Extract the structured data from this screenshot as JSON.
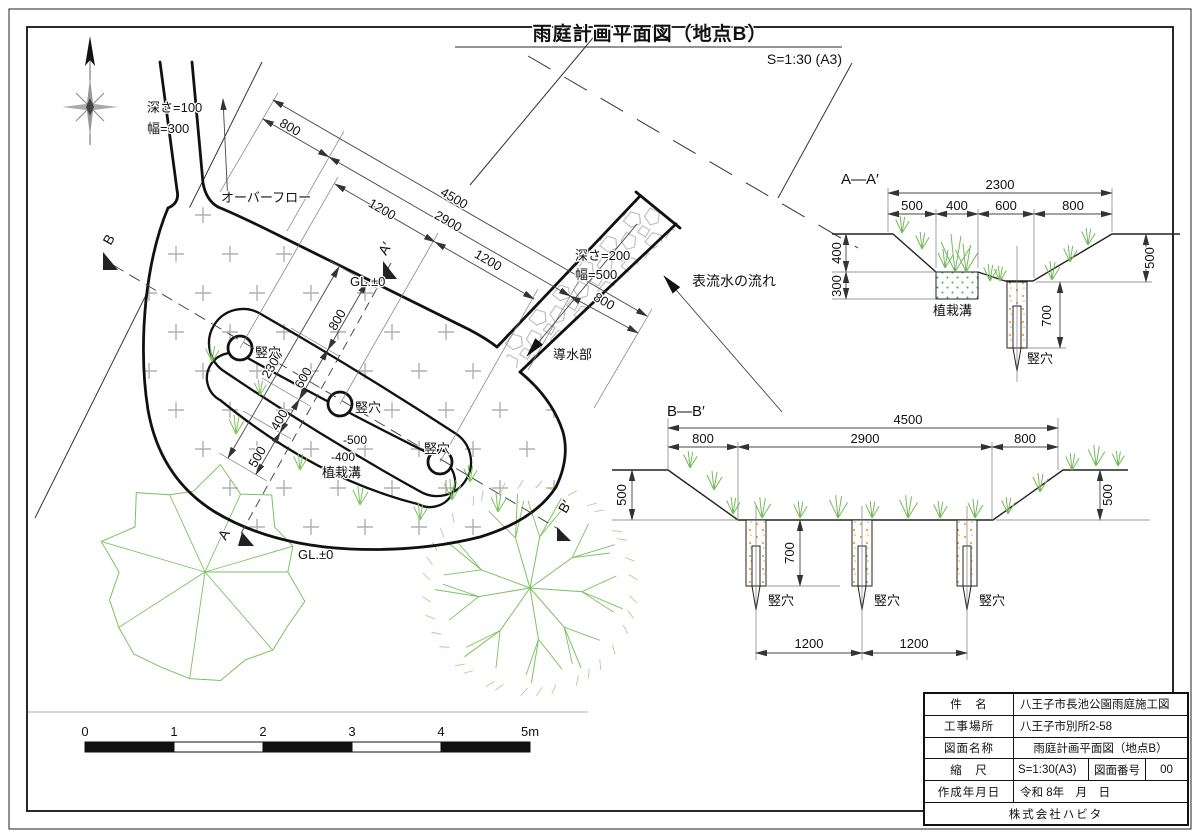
{
  "title": {
    "text": "雨庭計画平面図（地点B）",
    "scale": "S=1:30 (A3)"
  },
  "scale_bar": {
    "ticks": [
      "0",
      "1",
      "2",
      "3",
      "4",
      "5m"
    ]
  },
  "title_block": {
    "rows": [
      {
        "label": "件　名",
        "value": "八王子市長池公園雨庭施工図"
      },
      {
        "label": "工事場所",
        "value": "八王子市別所2-58"
      },
      {
        "label": "図面名称",
        "value": "雨庭計画平面図（地点B）"
      },
      {
        "label": "縮　尺",
        "value": "S=1:30(A3)",
        "label2": "図面番号",
        "value2": "00"
      },
      {
        "label": "作成年月日",
        "value": "令和 8年　月　日"
      }
    ],
    "company": "株式会社ハビタ"
  },
  "labels": [
    {
      "name": "drawing-title",
      "text": "雨庭計画平面図（地点B）",
      "x": 650,
      "y": 40,
      "size": 19,
      "anchor": "middle",
      "bold": true
    },
    {
      "name": "drawing-scale-note",
      "text": "S=1:30 (A3)",
      "x": 842,
      "y": 64,
      "size": 14,
      "anchor": "end"
    },
    {
      "name": "inflow-note-depth",
      "text": "深さ=100",
      "x": 147,
      "y": 112,
      "size": 13,
      "anchor": "start"
    },
    {
      "name": "inflow-note-width",
      "text": "幅=300",
      "x": 147,
      "y": 133,
      "size": 13,
      "anchor": "start"
    },
    {
      "name": "overflow-label",
      "text": "オーバーフロー",
      "x": 221,
      "y": 202,
      "size": 13,
      "anchor": "start"
    },
    {
      "name": "dim-800-top-left",
      "text": "800",
      "x": 288,
      "y": 131,
      "size": 13,
      "anchor": "middle",
      "rot": 30
    },
    {
      "name": "dim-4500",
      "text": "4500",
      "x": 452,
      "y": 202,
      "size": 13,
      "anchor": "middle",
      "rot": 30
    },
    {
      "name": "dim-1200-left",
      "text": "1200",
      "x": 380,
      "y": 213,
      "size": 13,
      "anchor": "middle",
      "rot": 30
    },
    {
      "name": "dim-2900",
      "text": "2900",
      "x": 446,
      "y": 225,
      "size": 13,
      "anchor": "middle",
      "rot": 30
    },
    {
      "name": "dim-1200-right",
      "text": "1200",
      "x": 486,
      "y": 264,
      "size": 13,
      "anchor": "middle",
      "rot": 30
    },
    {
      "name": "dim-800-conduit",
      "text": "800",
      "x": 602,
      "y": 305,
      "size": 13,
      "anchor": "middle",
      "rot": 30
    },
    {
      "name": "dim-2300-cross",
      "text": "2300",
      "x": 276,
      "y": 367,
      "size": 13,
      "anchor": "middle",
      "rot": -60
    },
    {
      "name": "dim-800-cross",
      "text": "800",
      "x": 341,
      "y": 322,
      "size": 13,
      "anchor": "middle",
      "rot": -60
    },
    {
      "name": "dim-600-cross",
      "text": "600",
      "x": 307,
      "y": 380,
      "size": 13,
      "anchor": "middle",
      "rot": -60
    },
    {
      "name": "dim-400-cross",
      "text": "400",
      "x": 283,
      "y": 422,
      "size": 13,
      "anchor": "middle",
      "rot": -60
    },
    {
      "name": "dim-500-cross",
      "text": "500",
      "x": 261,
      "y": 459,
      "size": 13,
      "anchor": "middle",
      "rot": -60
    },
    {
      "name": "gl-label-top",
      "text": "GL.±0",
      "x": 350,
      "y": 286,
      "size": 13,
      "anchor": "start"
    },
    {
      "name": "gl-label-bottom",
      "text": "GL.±0",
      "x": 298,
      "y": 559,
      "size": 13,
      "anchor": "start"
    },
    {
      "name": "section-mark-a-prime",
      "text": "A′",
      "x": 389,
      "y": 251,
      "size": 14,
      "anchor": "middle",
      "rot": -60
    },
    {
      "name": "section-mark-a",
      "text": "A",
      "x": 228,
      "y": 537,
      "size": 14,
      "anchor": "middle",
      "rot": -60
    },
    {
      "name": "section-mark-b",
      "text": "B",
      "x": 113,
      "y": 242,
      "size": 14,
      "anchor": "middle",
      "rot": -60
    },
    {
      "name": "section-mark-b-prime",
      "text": "B′",
      "x": 569,
      "y": 509,
      "size": 14,
      "anchor": "middle",
      "rot": -60
    },
    {
      "name": "pit-label-plan-1",
      "text": "竪穴",
      "x": 255,
      "y": 357,
      "size": 13,
      "anchor": "start"
    },
    {
      "name": "pit-label-plan-2",
      "text": "竪穴",
      "x": 355,
      "y": 412,
      "size": 13,
      "anchor": "start"
    },
    {
      "name": "pit-label-plan-3",
      "text": "竪穴",
      "x": 424,
      "y": 453,
      "size": 13,
      "anchor": "start"
    },
    {
      "name": "level-label-minus500",
      "text": "-500",
      "x": 343,
      "y": 444,
      "size": 12,
      "anchor": "start"
    },
    {
      "name": "level-label-minus400",
      "text": "-400",
      "x": 331,
      "y": 461,
      "size": 12,
      "anchor": "start"
    },
    {
      "name": "planting-label-plan",
      "text": "植栽溝",
      "x": 322,
      "y": 477,
      "size": 13,
      "anchor": "start"
    },
    {
      "name": "conduit-note-depth",
      "text": "深さ=200",
      "x": 575,
      "y": 260,
      "size": 13,
      "anchor": "start"
    },
    {
      "name": "conduit-note-width",
      "text": "幅=500",
      "x": 575,
      "y": 279,
      "size": 13,
      "anchor": "start"
    },
    {
      "name": "conduit-label",
      "text": "導水部",
      "x": 553,
      "y": 359,
      "size": 13,
      "anchor": "start"
    },
    {
      "name": "surface-flow-label",
      "text": "表流水の流れ",
      "x": 692,
      "y": 286,
      "size": 14,
      "anchor": "start"
    },
    {
      "name": "section-aa-title",
      "text": "A—A′",
      "x": 841,
      "y": 184,
      "size": 15,
      "anchor": "start"
    },
    {
      "name": "dim-aa-2300",
      "text": "2300",
      "x": 1000,
      "y": 189,
      "size": 13,
      "anchor": "middle"
    },
    {
      "name": "dim-aa-500",
      "text": "500",
      "x": 912,
      "y": 210,
      "size": 13,
      "anchor": "middle"
    },
    {
      "name": "dim-aa-400",
      "text": "400",
      "x": 957,
      "y": 210,
      "size": 13,
      "anchor": "middle"
    },
    {
      "name": "dim-aa-600",
      "text": "600",
      "x": 1006,
      "y": 210,
      "size": 13,
      "anchor": "middle"
    },
    {
      "name": "dim-aa-800",
      "text": "800",
      "x": 1073,
      "y": 210,
      "size": 13,
      "anchor": "middle"
    },
    {
      "name": "dim-aa-400v",
      "text": "400",
      "x": 841,
      "y": 253,
      "size": 13,
      "anchor": "middle",
      "rot": -90
    },
    {
      "name": "dim-aa-300v",
      "text": "300",
      "x": 841,
      "y": 286,
      "size": 13,
      "anchor": "middle",
      "rot": -90
    },
    {
      "name": "dim-aa-500v",
      "text": "500",
      "x": 1154,
      "y": 258,
      "size": 13,
      "anchor": "middle",
      "rot": -90
    },
    {
      "name": "dim-aa-700v",
      "text": "700",
      "x": 1051,
      "y": 316,
      "size": 13,
      "anchor": "middle",
      "rot": -90
    },
    {
      "name": "planting-label-aa",
      "text": "植栽溝",
      "x": 933,
      "y": 315,
      "size": 13,
      "anchor": "start"
    },
    {
      "name": "pit-label-aa",
      "text": "竪穴",
      "x": 1027,
      "y": 363,
      "size": 13,
      "anchor": "start"
    },
    {
      "name": "section-bb-title",
      "text": "B—B′",
      "x": 667,
      "y": 416,
      "size": 15,
      "anchor": "start"
    },
    {
      "name": "dim-bb-4500",
      "text": "4500",
      "x": 908,
      "y": 424,
      "size": 13,
      "anchor": "middle"
    },
    {
      "name": "dim-bb-800l",
      "text": "800",
      "x": 703,
      "y": 443,
      "size": 13,
      "anchor": "middle"
    },
    {
      "name": "dim-bb-2900",
      "text": "2900",
      "x": 865,
      "y": 443,
      "size": 13,
      "anchor": "middle"
    },
    {
      "name": "dim-bb-800r",
      "text": "800",
      "x": 1025,
      "y": 443,
      "size": 13,
      "anchor": "middle"
    },
    {
      "name": "dim-bb-500l",
      "text": "500",
      "x": 626,
      "y": 495,
      "size": 13,
      "anchor": "middle",
      "rot": -90
    },
    {
      "name": "dim-bb-500r",
      "text": "500",
      "x": 1112,
      "y": 495,
      "size": 13,
      "anchor": "middle",
      "rot": -90
    },
    {
      "name": "dim-bb-700",
      "text": "700",
      "x": 794,
      "y": 553,
      "size": 13,
      "anchor": "middle",
      "rot": -90
    },
    {
      "name": "dim-bb-1200l",
      "text": "1200",
      "x": 809,
      "y": 648,
      "size": 13,
      "anchor": "middle"
    },
    {
      "name": "dim-bb-1200r",
      "text": "1200",
      "x": 914,
      "y": 648,
      "size": 13,
      "anchor": "middle"
    },
    {
      "name": "pit-label-bb-1",
      "text": "竪穴",
      "x": 768,
      "y": 605,
      "size": 13,
      "anchor": "start"
    },
    {
      "name": "pit-label-bb-2",
      "text": "竪穴",
      "x": 874,
      "y": 605,
      "size": 13,
      "anchor": "start"
    },
    {
      "name": "pit-label-bb-3",
      "text": "竪穴",
      "x": 979,
      "y": 605,
      "size": 13,
      "anchor": "start"
    }
  ]
}
